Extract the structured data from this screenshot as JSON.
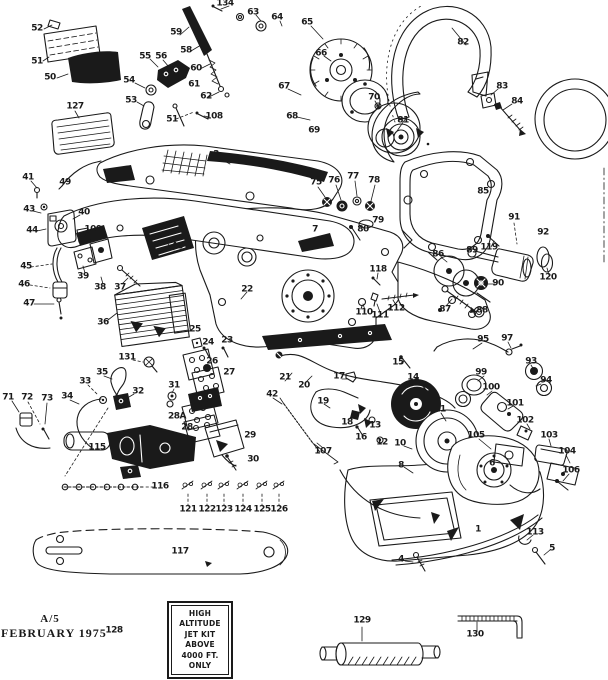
{
  "document": {
    "footer_revision": "A/5",
    "footer_date": "FEBRUARY 1975"
  },
  "note_box": {
    "lines": [
      "HIGH",
      "ALTITUDE",
      "JET KIT",
      "ABOVE",
      "4000 FT.",
      "ONLY"
    ]
  },
  "colors": {
    "ink": "#1a1a1a",
    "paper": "#ffffff"
  },
  "callouts": [
    {
      "label": "52",
      "x": 37,
      "y": 29
    },
    {
      "label": "51",
      "x": 37,
      "y": 62
    },
    {
      "label": "50",
      "x": 50,
      "y": 78
    },
    {
      "label": "127",
      "x": 75,
      "y": 107
    },
    {
      "label": "55",
      "x": 145,
      "y": 57
    },
    {
      "label": "56",
      "x": 161,
      "y": 57
    },
    {
      "label": "54",
      "x": 129,
      "y": 81
    },
    {
      "label": "53",
      "x": 131,
      "y": 101
    },
    {
      "label": "59",
      "x": 176,
      "y": 33
    },
    {
      "label": "58",
      "x": 186,
      "y": 51
    },
    {
      "label": "60",
      "x": 196,
      "y": 69
    },
    {
      "label": "61",
      "x": 194,
      "y": 85
    },
    {
      "label": "62",
      "x": 206,
      "y": 97
    },
    {
      "label": "51",
      "x": 172,
      "y": 120
    },
    {
      "label": "108",
      "x": 214,
      "y": 117
    },
    {
      "label": "134",
      "x": 225,
      "y": 4
    },
    {
      "label": "63",
      "x": 253,
      "y": 13
    },
    {
      "label": "64",
      "x": 277,
      "y": 18
    },
    {
      "label": "65",
      "x": 307,
      "y": 23
    },
    {
      "label": "66",
      "x": 321,
      "y": 54
    },
    {
      "label": "67",
      "x": 284,
      "y": 87
    },
    {
      "label": "68",
      "x": 292,
      "y": 117
    },
    {
      "label": "69",
      "x": 314,
      "y": 131
    },
    {
      "label": "70",
      "x": 374,
      "y": 98
    },
    {
      "label": "81",
      "x": 403,
      "y": 121
    },
    {
      "label": "82",
      "x": 463,
      "y": 43
    },
    {
      "label": "83",
      "x": 502,
      "y": 87
    },
    {
      "label": "84",
      "x": 517,
      "y": 102
    },
    {
      "label": "3",
      "x": 216,
      "y": 155
    },
    {
      "label": "7",
      "x": 315,
      "y": 230
    },
    {
      "label": "22",
      "x": 247,
      "y": 290
    },
    {
      "label": "41",
      "x": 28,
      "y": 178
    },
    {
      "label": "49",
      "x": 65,
      "y": 183
    },
    {
      "label": "43",
      "x": 29,
      "y": 210
    },
    {
      "label": "44",
      "x": 32,
      "y": 231
    },
    {
      "label": "40",
      "x": 84,
      "y": 213
    },
    {
      "label": "109",
      "x": 93,
      "y": 230
    },
    {
      "label": "45",
      "x": 26,
      "y": 267
    },
    {
      "label": "46",
      "x": 24,
      "y": 285
    },
    {
      "label": "47",
      "x": 29,
      "y": 304
    },
    {
      "label": "39",
      "x": 83,
      "y": 277
    },
    {
      "label": "38",
      "x": 100,
      "y": 288
    },
    {
      "label": "37",
      "x": 120,
      "y": 288
    },
    {
      "label": "48",
      "x": 177,
      "y": 247
    },
    {
      "label": "36",
      "x": 103,
      "y": 323
    },
    {
      "label": "75",
      "x": 316,
      "y": 183
    },
    {
      "label": "76",
      "x": 334,
      "y": 181
    },
    {
      "label": "77",
      "x": 353,
      "y": 177
    },
    {
      "label": "78",
      "x": 374,
      "y": 181
    },
    {
      "label": "79",
      "x": 378,
      "y": 221
    },
    {
      "label": "80",
      "x": 363,
      "y": 230
    },
    {
      "label": "85",
      "x": 483,
      "y": 192
    },
    {
      "label": "91",
      "x": 514,
      "y": 218
    },
    {
      "label": "92",
      "x": 543,
      "y": 233
    },
    {
      "label": "119",
      "x": 489,
      "y": 248
    },
    {
      "label": "89",
      "x": 472,
      "y": 251
    },
    {
      "label": "86",
      "x": 438,
      "y": 255
    },
    {
      "label": "118",
      "x": 378,
      "y": 270
    },
    {
      "label": "120",
      "x": 548,
      "y": 278
    },
    {
      "label": "90",
      "x": 498,
      "y": 284
    },
    {
      "label": "112",
      "x": 396,
      "y": 309
    },
    {
      "label": "87",
      "x": 445,
      "y": 310
    },
    {
      "label": "88",
      "x": 482,
      "y": 311
    },
    {
      "label": "110",
      "x": 364,
      "y": 313
    },
    {
      "label": "111",
      "x": 380,
      "y": 316
    },
    {
      "label": "25",
      "x": 195,
      "y": 330
    },
    {
      "label": "24",
      "x": 208,
      "y": 343
    },
    {
      "label": "23",
      "x": 227,
      "y": 341
    },
    {
      "label": "131",
      "x": 127,
      "y": 358
    },
    {
      "label": "26",
      "x": 212,
      "y": 362
    },
    {
      "label": "35",
      "x": 102,
      "y": 373
    },
    {
      "label": "27",
      "x": 229,
      "y": 373
    },
    {
      "label": "17",
      "x": 339,
      "y": 377
    },
    {
      "label": "21",
      "x": 285,
      "y": 378
    },
    {
      "label": "15",
      "x": 398,
      "y": 363
    },
    {
      "label": "14",
      "x": 413,
      "y": 378
    },
    {
      "label": "33",
      "x": 85,
      "y": 382
    },
    {
      "label": "31",
      "x": 174,
      "y": 386
    },
    {
      "label": "20",
      "x": 304,
      "y": 386
    },
    {
      "label": "32",
      "x": 138,
      "y": 392
    },
    {
      "label": "42",
      "x": 272,
      "y": 395
    },
    {
      "label": "34",
      "x": 67,
      "y": 397
    },
    {
      "label": "71",
      "x": 8,
      "y": 398
    },
    {
      "label": "72",
      "x": 27,
      "y": 398
    },
    {
      "label": "73",
      "x": 47,
      "y": 399
    },
    {
      "label": "19",
      "x": 323,
      "y": 402
    },
    {
      "label": "97",
      "x": 507,
      "y": 339
    },
    {
      "label": "95",
      "x": 483,
      "y": 340
    },
    {
      "label": "93",
      "x": 531,
      "y": 362
    },
    {
      "label": "99",
      "x": 481,
      "y": 373
    },
    {
      "label": "94",
      "x": 546,
      "y": 381
    },
    {
      "label": "100",
      "x": 491,
      "y": 388
    },
    {
      "label": "101",
      "x": 515,
      "y": 404
    },
    {
      "label": "11",
      "x": 440,
      "y": 410
    },
    {
      "label": "102",
      "x": 525,
      "y": 421
    },
    {
      "label": "28A",
      "x": 177,
      "y": 417
    },
    {
      "label": "18",
      "x": 347,
      "y": 423
    },
    {
      "label": "13",
      "x": 375,
      "y": 426
    },
    {
      "label": "28",
      "x": 187,
      "y": 428
    },
    {
      "label": "29",
      "x": 250,
      "y": 436
    },
    {
      "label": "16",
      "x": 361,
      "y": 438
    },
    {
      "label": "103",
      "x": 549,
      "y": 436
    },
    {
      "label": "105",
      "x": 476,
      "y": 436
    },
    {
      "label": "12",
      "x": 382,
      "y": 443
    },
    {
      "label": "10",
      "x": 400,
      "y": 444
    },
    {
      "label": "115",
      "x": 97,
      "y": 448
    },
    {
      "label": "107",
      "x": 323,
      "y": 452
    },
    {
      "label": "104",
      "x": 567,
      "y": 452
    },
    {
      "label": "30",
      "x": 253,
      "y": 460
    },
    {
      "label": "8",
      "x": 401,
      "y": 466
    },
    {
      "label": "6",
      "x": 492,
      "y": 464
    },
    {
      "label": "106",
      "x": 571,
      "y": 471
    },
    {
      "label": "116",
      "x": 160,
      "y": 487
    },
    {
      "label": "121",
      "x": 188,
      "y": 510
    },
    {
      "label": "122",
      "x": 207,
      "y": 510
    },
    {
      "label": "123",
      "x": 224,
      "y": 510
    },
    {
      "label": "124",
      "x": 243,
      "y": 510
    },
    {
      "label": "125",
      "x": 262,
      "y": 510
    },
    {
      "label": "126",
      "x": 279,
      "y": 510
    },
    {
      "label": "1",
      "x": 478,
      "y": 530
    },
    {
      "label": "113",
      "x": 535,
      "y": 533
    },
    {
      "label": "117",
      "x": 180,
      "y": 552
    },
    {
      "label": "5",
      "x": 552,
      "y": 549
    },
    {
      "label": "4",
      "x": 401,
      "y": 560
    },
    {
      "label": "129",
      "x": 362,
      "y": 621
    },
    {
      "label": "128",
      "x": 114,
      "y": 631
    },
    {
      "label": "130",
      "x": 475,
      "y": 635
    }
  ]
}
